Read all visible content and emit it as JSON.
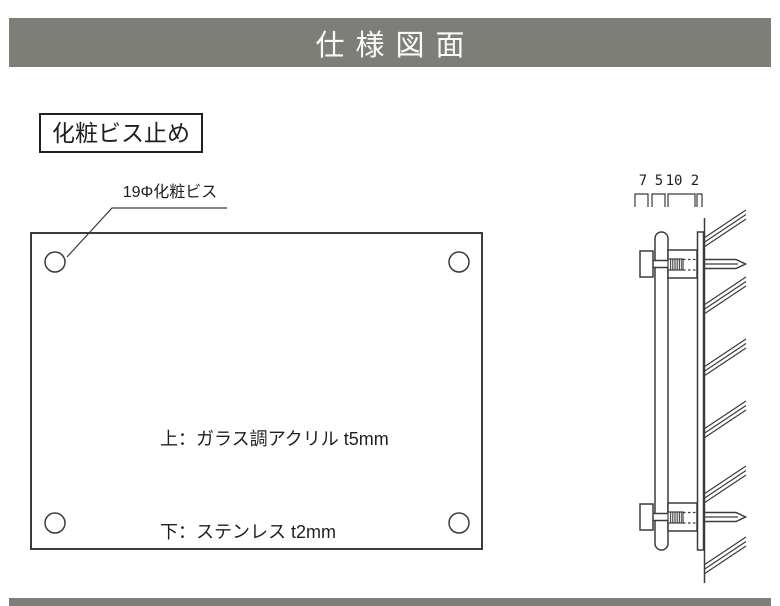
{
  "header": {
    "title": "仕様図面"
  },
  "method_label": {
    "text": "化粧ビス止め"
  },
  "callout": {
    "text": "19Φ化粧ビス"
  },
  "material_note": {
    "line1": "上：ガラス調アクリル t5mm",
    "line2": "下：ステンレス t2mm"
  },
  "side_view": {
    "dimension_values": [
      "7",
      "5",
      "10",
      "2"
    ]
  },
  "colors": {
    "bar_gray": "#7d7e78",
    "line": "#3b3b38",
    "text": "#1f1f1f",
    "background": "#ffffff"
  }
}
